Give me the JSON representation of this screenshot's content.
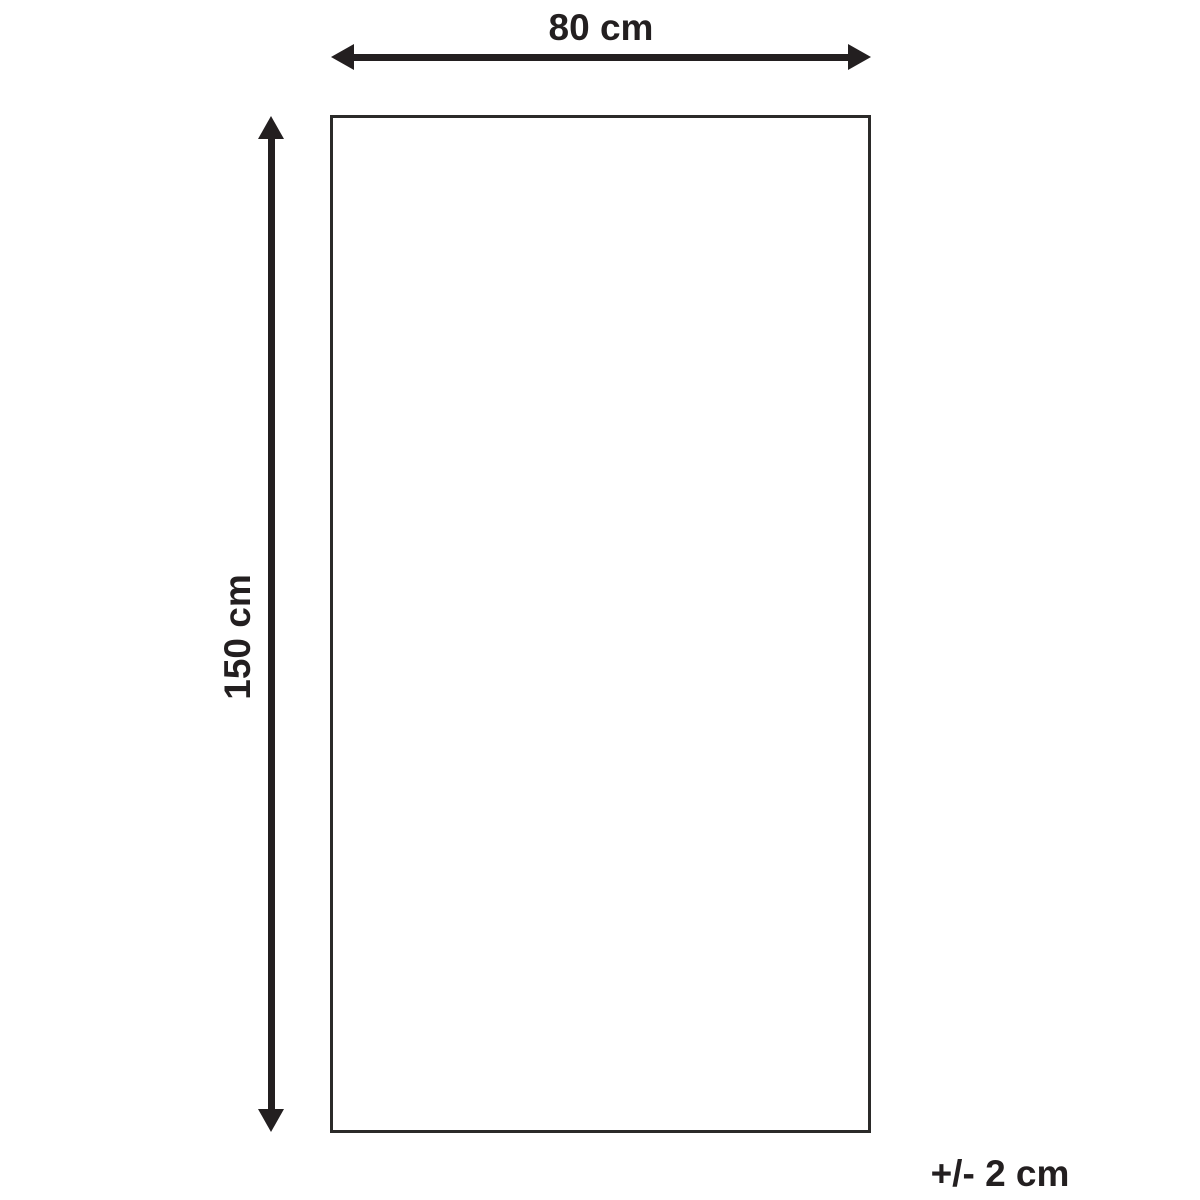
{
  "diagram": {
    "title": "product-dimension-diagram",
    "width_label": "80 cm",
    "height_label": "150 cm",
    "tolerance_label": "+/- 2 cm"
  },
  "colors": {
    "line": "#231f20",
    "text": "#231f20",
    "outline": "#2b2a29",
    "bg": "#ffffff"
  }
}
